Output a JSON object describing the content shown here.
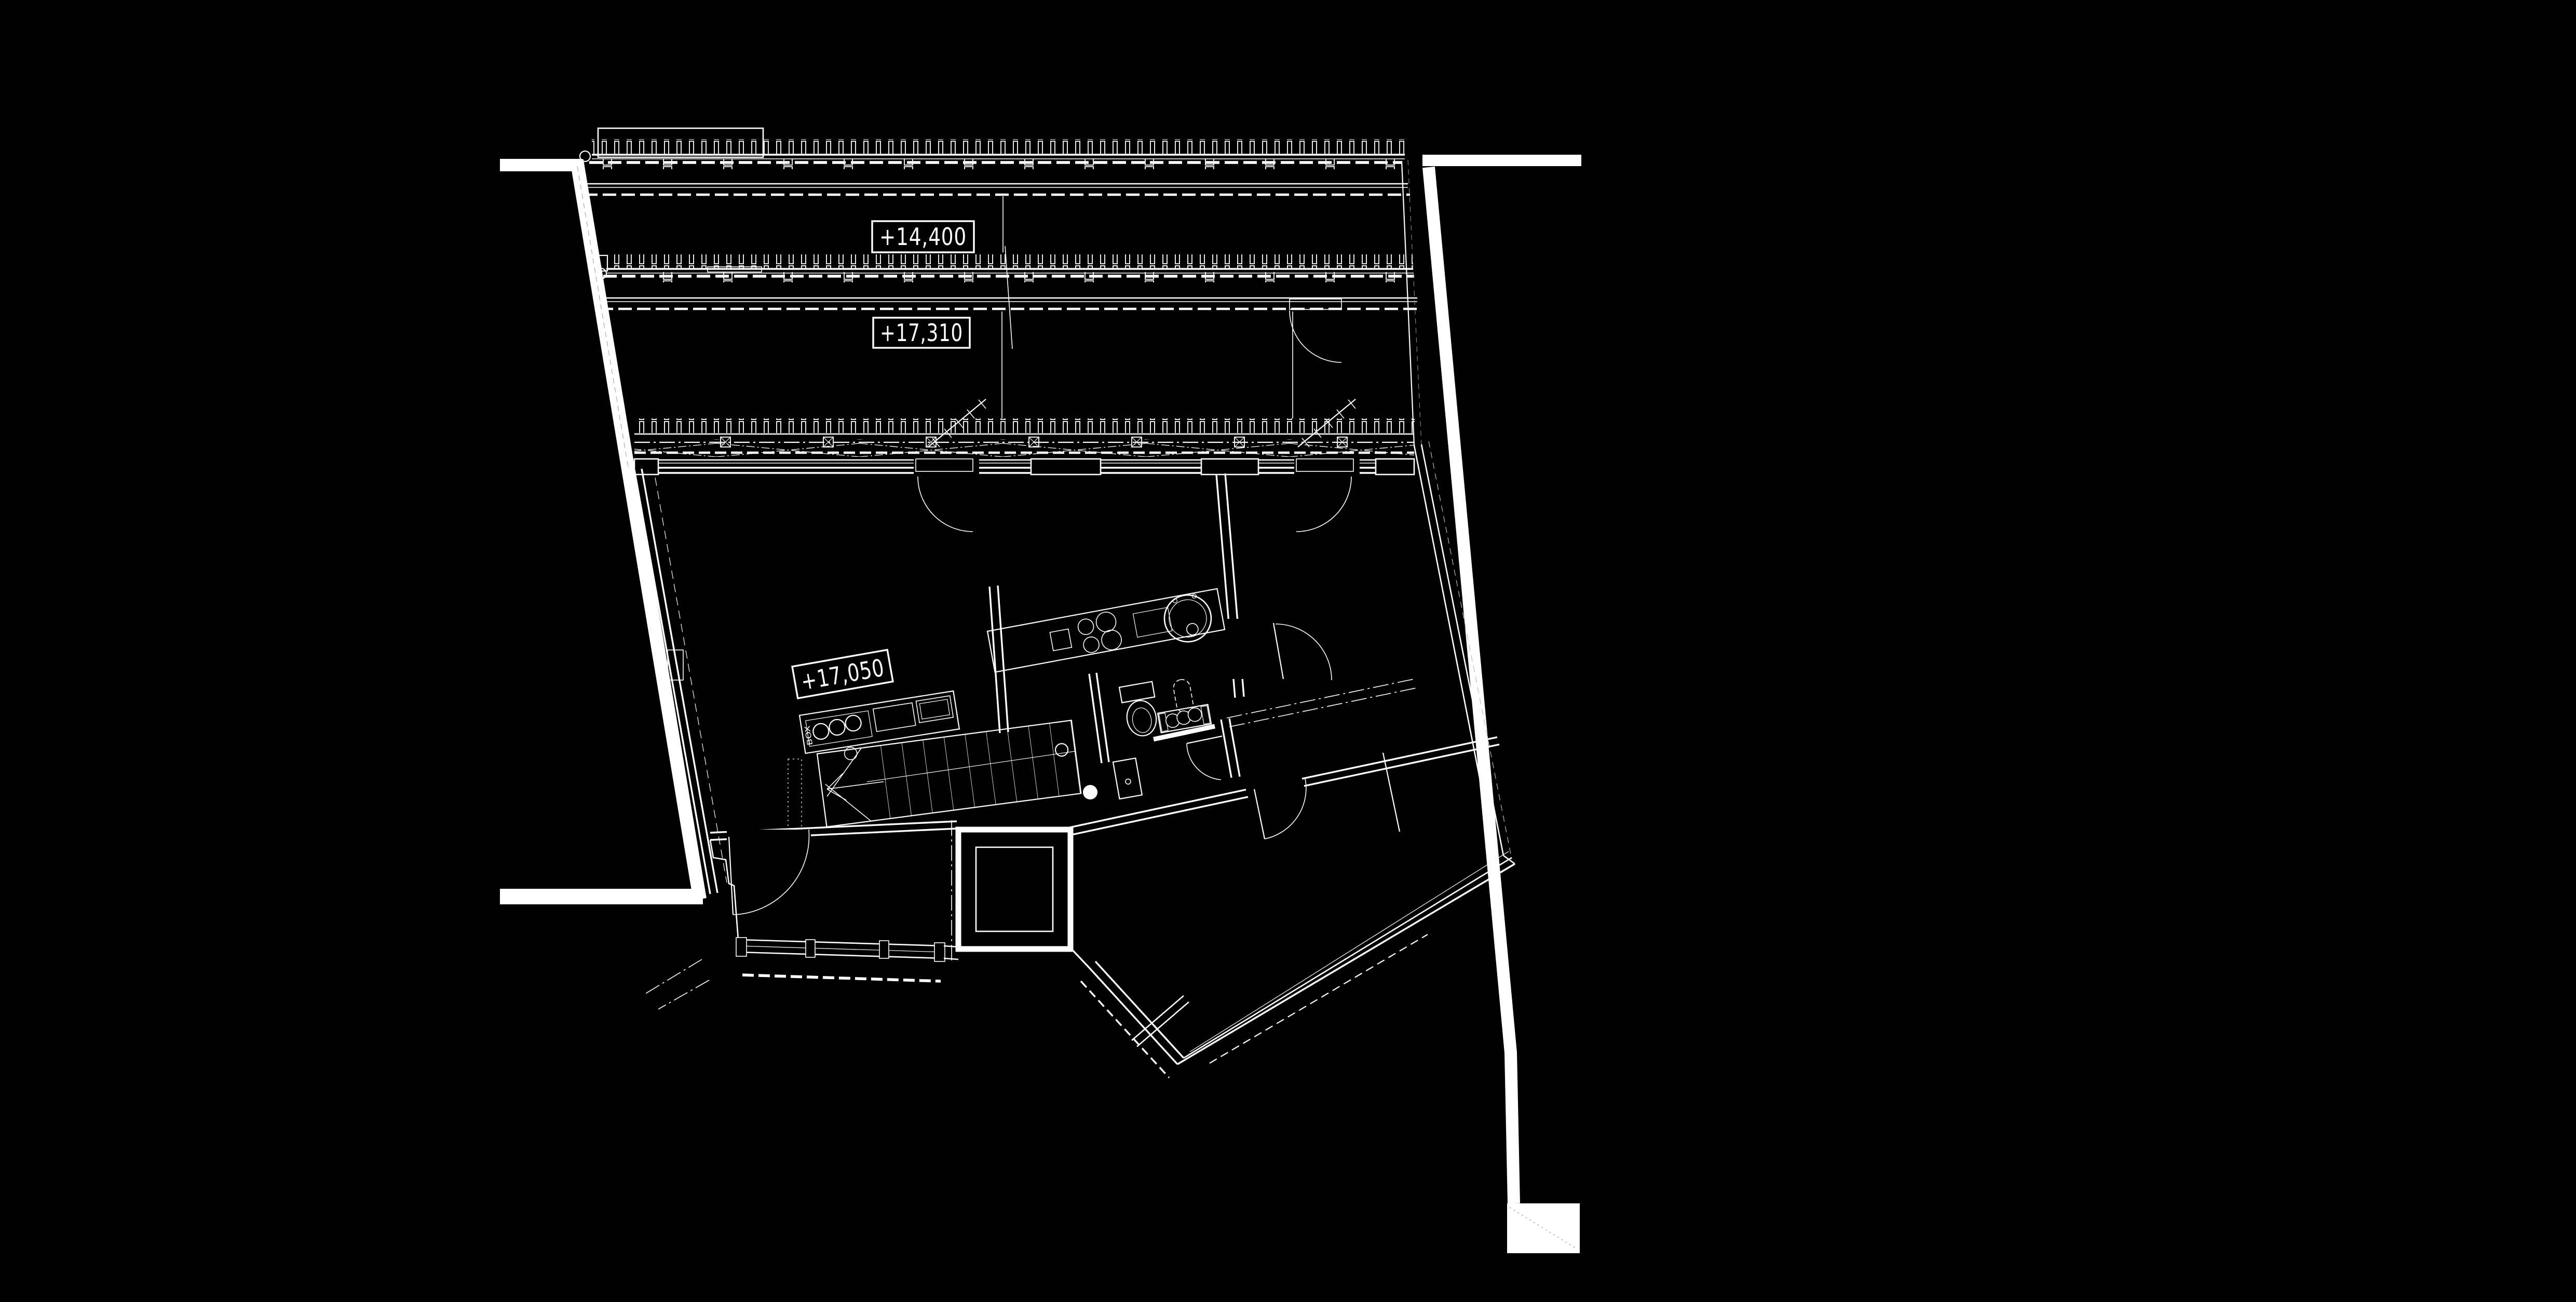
{
  "page": {
    "background": "#000000",
    "ink": "#ffffff",
    "faint": "#bbbbbb",
    "description": "CAD floor plan, white linework on black"
  },
  "plan": {
    "labels": {
      "level_roof": "+14,400",
      "level_terrace": "+17,310",
      "level_floor": "+17,050",
      "island_marking": "BOX"
    }
  }
}
